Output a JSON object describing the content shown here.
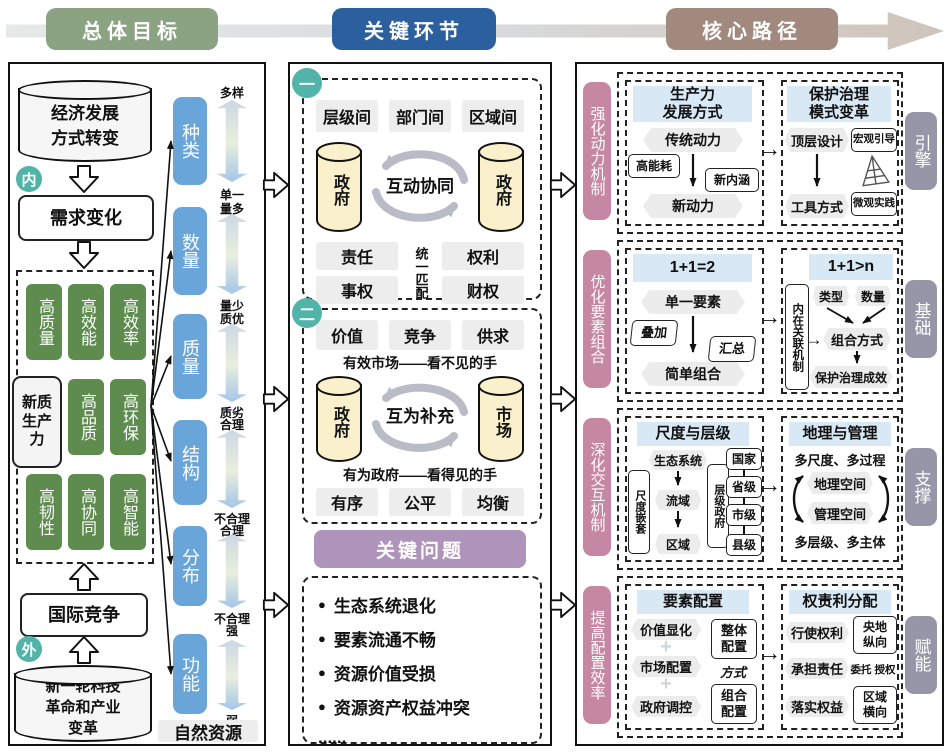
{
  "topbar": {
    "stage1": "总体目标",
    "stage2": "关键环节",
    "stage3": "核心路径"
  },
  "colors": {
    "stage_green": "#8ba383",
    "stage_blue": "#2b5f9e",
    "stage_taupe": "#a18a7d",
    "green_box": "#5d8c4e",
    "blue_box": "#69a5d9",
    "teal_badge": "#52b3a8",
    "pink_label": "#c687a2",
    "gray_label": "#9696a8",
    "purple_header": "#ae93bb",
    "light_blue_header": "#d9e8f5",
    "cylinder_yellow": "#faf0cb",
    "gray_tag": "#ededed"
  },
  "icons": {
    "bullet": "●",
    "down_arrow": "↓",
    "right_arrow": "→",
    "plus": "+"
  },
  "left": {
    "cylinder_top": "经济发展方式转变",
    "badge_inner": "内",
    "demand": "需求变化",
    "nq_label": "新质生产力",
    "grid": [
      "高质量",
      "高效能",
      "高效率",
      "高品质",
      "高环保",
      "高韧性",
      "高协同",
      "高智能"
    ],
    "competition": "国际竞争",
    "badge_outer": "外",
    "cylinder_bottom": "新一轮科技革命和产业变革",
    "categories": [
      {
        "name": "种类",
        "top": "多样",
        "bottom": "单一"
      },
      {
        "name": "数量",
        "top": "量多",
        "bottom": "量少"
      },
      {
        "name": "质量",
        "top": "质优",
        "bottom": "质劣"
      },
      {
        "name": "结构",
        "top": "合理",
        "bottom": "不合理"
      },
      {
        "name": "分布",
        "top": "合理",
        "bottom": "不合理"
      },
      {
        "name": "功能",
        "top": "强",
        "bottom": "弱"
      }
    ],
    "natural": "自然资源"
  },
  "middle": {
    "s1": {
      "badge": "一",
      "tags": [
        "层级间",
        "部门间",
        "区域间"
      ],
      "cyl_left": "政府",
      "cyl_right": "政府",
      "cycle": "互动协同",
      "vertical": "统一匹配",
      "r1l": "责任",
      "r1r": "权利",
      "r2l": "事权",
      "r2r": "财权"
    },
    "s2": {
      "badge": "二",
      "tags": [
        "价值",
        "竞争",
        "供求"
      ],
      "line_top": "有效市场——看不见的手",
      "cyl_left": "政府",
      "cyl_right": "市场",
      "cycle": "互为补充",
      "line_bottom": "有为政府——看得见的手",
      "tags_bottom": [
        "有序",
        "公平",
        "均衡"
      ]
    },
    "problems": {
      "title": "关键问题",
      "items": [
        "生态系统退化",
        "要素流通不畅",
        "资源价值受损",
        "资源资产权益冲突"
      ],
      "more": "......"
    }
  },
  "right": {
    "s1": {
      "side": "强化动力机制",
      "tag": "引擎",
      "a_title1": "生产力",
      "a_title2": "发展方式",
      "a_from": "传统动力",
      "a_left": "高能耗",
      "a_right": "新内涵",
      "a_to": "新动力",
      "b_title1": "保护治理",
      "b_title2": "模式变革",
      "b_from": "顶层设计",
      "b_to": "工具方式",
      "b_tag1": "宏观引导",
      "b_tag2": "微观实践"
    },
    "s2": {
      "side": "优化要素组合",
      "tag": "基础",
      "a_title": "1+1=2",
      "a_from": "单一要素",
      "a_left": "叠加",
      "a_right": "汇总",
      "a_to": "简单组合",
      "b_title": "1+1>n",
      "b_vertical": "内在关联机制",
      "b_top1": "类型",
      "b_top2": "数量",
      "b_mid": "组合方式",
      "b_bottom": "保护治理成效"
    },
    "s3": {
      "side": "深化交互机制",
      "tag": "支撑",
      "a_title": "尺度与层级",
      "a_vertical": "尺度嵌套",
      "a_chain": [
        "生态系统",
        "流域",
        "区域"
      ],
      "a_mid_vertical": "层级政府",
      "a_levels": [
        "国家",
        "省级",
        "市级",
        "县级"
      ],
      "b_title": "地理与管理",
      "b_line1": "多尺度、多过程",
      "b_s1": "地理空间",
      "b_s2": "管理空间",
      "b_line2": "多层级、多主体"
    },
    "s4": {
      "side": "提高配置效率",
      "tag": "赋能",
      "a_title": "要素配置",
      "a_items": [
        "价值显化",
        "市场配置",
        "政府调控"
      ],
      "a_r1": "整体配置",
      "a_mid": "方式",
      "a_r2": "组合配置",
      "b_title": "权责利分配",
      "b_r1": "行使权利",
      "b_r1t": "央地纵向",
      "b_r2": "承担责任",
      "b_r2t": "委托 授权",
      "b_r3": "落实权益",
      "b_r3t": "区域横向"
    }
  }
}
